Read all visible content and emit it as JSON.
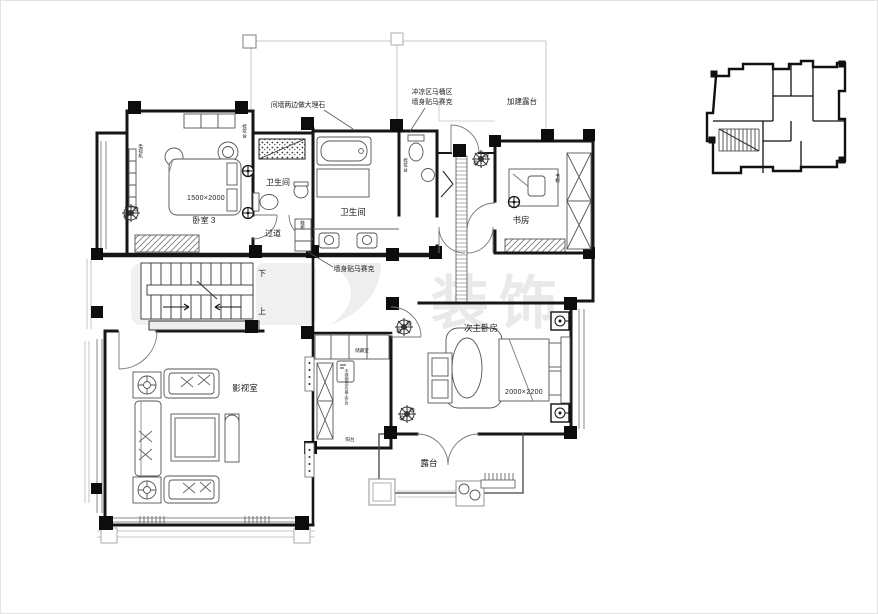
{
  "plan": {
    "rooms": {
      "bedroom3": {
        "name": "卧室 3",
        "bed_dim": "1500×2000",
        "tv_label": "电视机",
        "dresser_label": "梳妆台"
      },
      "bath_small": {
        "name": "卫生间"
      },
      "hallway": {
        "name": "过道",
        "shoe_cabinet": "鞋柜"
      },
      "bath_main": {
        "name": "卫生间",
        "dresser_label": "梳妆台"
      },
      "study": {
        "name": "书房",
        "bookcase_label": "书橱"
      },
      "stairs": {
        "up": "上",
        "down": "下"
      },
      "media_room": {
        "name": "影视室"
      },
      "storage": {
        "name": "储藏室"
      },
      "laundry": {
        "name": "阳台",
        "worktop_note": "不锈钢洗衣盆工作台"
      },
      "master2": {
        "name": "次主卧房",
        "bed_dim": "2000×2200"
      },
      "terrace": {
        "name": "露台"
      }
    },
    "annotations": {
      "marble": "间墙两边做大理石",
      "mosaic_line1": "冲凉区马桶区",
      "mosaic_line2": "墙身贴马赛克",
      "added_terrace": "加建露台",
      "mosaic_wall": "墙身贴马赛克"
    },
    "watermark": "装饰"
  }
}
